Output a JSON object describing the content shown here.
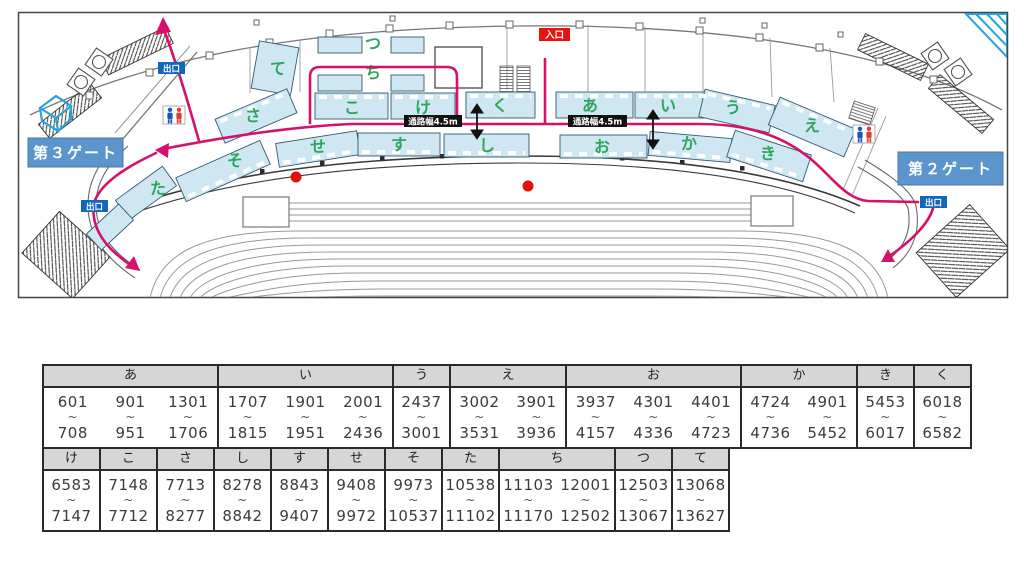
{
  "map": {
    "gate3": "第３ゲート",
    "gate2": "第２ゲート",
    "entrance": "入口",
    "exit": "出口",
    "aisle_width": "通路幅4.5m",
    "blocks_upper": {
      "te": "て",
      "sa": "さ",
      "tsu": "つ",
      "chi": "ち",
      "ko": "こ",
      "ke": "け",
      "ku": "く",
      "a": "あ",
      "i": "い",
      "u": "う",
      "e": "え"
    },
    "blocks_lower": {
      "ta": "た",
      "so": "そ",
      "se": "せ",
      "su": "す",
      "shi": "し",
      "o": "お",
      "ka": "か",
      "ki": "き"
    },
    "colors": {
      "route_pink": "#d6106b",
      "booth_blue": "#cfe6f3",
      "label_green": "#2ea55f",
      "gate_blue": "#5b95cc",
      "exit_blue": "#1467b8",
      "entrance_red": "#ee1111"
    }
  },
  "table": {
    "tilde": "~",
    "rows": [
      {
        "groups": [
          {
            "label": "あ",
            "ranges": [
              [
                "601",
                "708"
              ],
              [
                "901",
                "951"
              ],
              [
                "1301",
                "1706"
              ]
            ]
          },
          {
            "label": "い",
            "ranges": [
              [
                "1707",
                "1815"
              ],
              [
                "1901",
                "1951"
              ],
              [
                "2001",
                "2436"
              ]
            ]
          },
          {
            "label": "う",
            "ranges": [
              [
                "2437",
                "3001"
              ]
            ]
          },
          {
            "label": "え",
            "ranges": [
              [
                "3002",
                "3531"
              ],
              [
                "3901",
                "3936"
              ]
            ]
          },
          {
            "label": "お",
            "ranges": [
              [
                "3937",
                "4157"
              ],
              [
                "4301",
                "4336"
              ],
              [
                "4401",
                "4723"
              ]
            ]
          },
          {
            "label": "か",
            "ranges": [
              [
                "4724",
                "4736"
              ],
              [
                "4901",
                "5452"
              ]
            ]
          },
          {
            "label": "き",
            "ranges": [
              [
                "5453",
                "6017"
              ]
            ]
          },
          {
            "label": "く",
            "ranges": [
              [
                "6018",
                "6582"
              ]
            ]
          }
        ]
      },
      {
        "groups": [
          {
            "label": "け",
            "ranges": [
              [
                "6583",
                "7147"
              ]
            ]
          },
          {
            "label": "こ",
            "ranges": [
              [
                "7148",
                "7712"
              ]
            ]
          },
          {
            "label": "さ",
            "ranges": [
              [
                "7713",
                "8277"
              ]
            ]
          },
          {
            "label": "し",
            "ranges": [
              [
                "8278",
                "8842"
              ]
            ]
          },
          {
            "label": "す",
            "ranges": [
              [
                "8843",
                "9407"
              ]
            ]
          },
          {
            "label": "せ",
            "ranges": [
              [
                "9408",
                "9972"
              ]
            ]
          },
          {
            "label": "そ",
            "ranges": [
              [
                "9973",
                "10537"
              ]
            ]
          },
          {
            "label": "た",
            "ranges": [
              [
                "10538",
                "11102"
              ]
            ]
          },
          {
            "label": "ち",
            "ranges": [
              [
                "11103",
                "11170"
              ],
              [
                "12001",
                "12502"
              ]
            ]
          },
          {
            "label": "つ",
            "ranges": [
              [
                "12503",
                "13067"
              ]
            ]
          },
          {
            "label": "て",
            "ranges": [
              [
                "13068",
                "13627"
              ]
            ]
          }
        ]
      }
    ]
  }
}
